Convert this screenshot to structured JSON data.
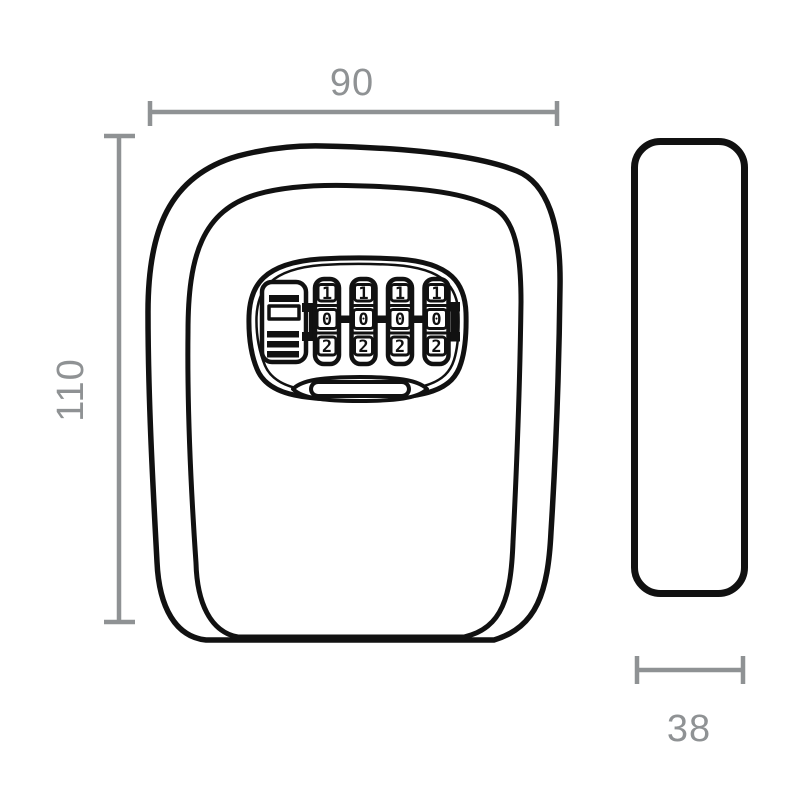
{
  "drawing": {
    "subject": "wall-mounted combination key safe, front and side orthographic views",
    "colors": {
      "background": "#ffffff",
      "line": "#111111",
      "dimension": "#8f9294"
    },
    "dimensions": {
      "width": {
        "label": "90"
      },
      "height": {
        "label": "110"
      },
      "depth": {
        "label": "38"
      }
    },
    "lock": {
      "wheels": [
        {
          "digits": [
            "1",
            "0",
            "2"
          ]
        },
        {
          "digits": [
            "1",
            "0",
            "2"
          ]
        },
        {
          "digits": [
            "1",
            "0",
            "2"
          ]
        },
        {
          "digits": [
            "1",
            "0",
            "2"
          ]
        }
      ]
    }
  }
}
